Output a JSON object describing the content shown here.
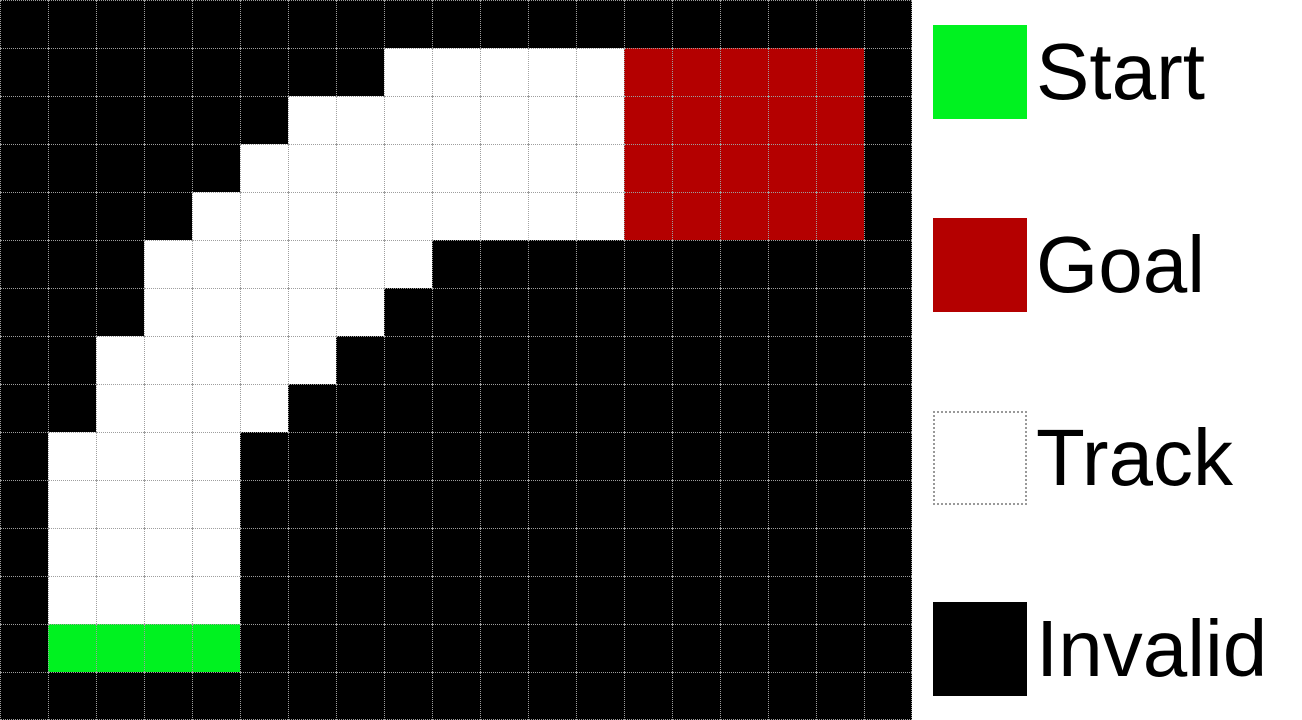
{
  "figure": {
    "kind": "racetrack-gridworld",
    "rows": 15,
    "cols": 19,
    "cell_px": 48,
    "map": [
      "...................",
      "........TTTTTGGGGG.",
      "......TTTTTTTGGGGG.",
      ".....TTTTTTTTGGGGG.",
      "....TTTTTTTTTGGGGG.",
      "...TTTTTT..........",
      "...TTTTT...........",
      "..TTTTT............",
      "..TTTT.............",
      ".TTTT..............",
      ".TTTT..............",
      ".TTTT..............",
      ".TTTT..............",
      ".SSSS..............",
      "..................."
    ],
    "cell_types": {
      "S": "start",
      "G": "goal",
      "T": "track",
      ".": "invalid"
    },
    "colors": {
      "start": "#00F220",
      "goal": "#B40000",
      "track": "#FFFFFF",
      "invalid": "#000000",
      "gridline": "#9E9E9E"
    }
  },
  "legend": {
    "items": [
      {
        "id": "start",
        "label": "Start",
        "swatch_color": "#00F220",
        "swatch_border": "none"
      },
      {
        "id": "goal",
        "label": "Goal",
        "swatch_color": "#B40000",
        "swatch_border": "none"
      },
      {
        "id": "track",
        "label": "Track",
        "swatch_color": "#FFFFFF",
        "swatch_border": "dotted"
      },
      {
        "id": "invalid",
        "label": "Invalid",
        "swatch_color": "#000000",
        "swatch_border": "none"
      }
    ]
  }
}
